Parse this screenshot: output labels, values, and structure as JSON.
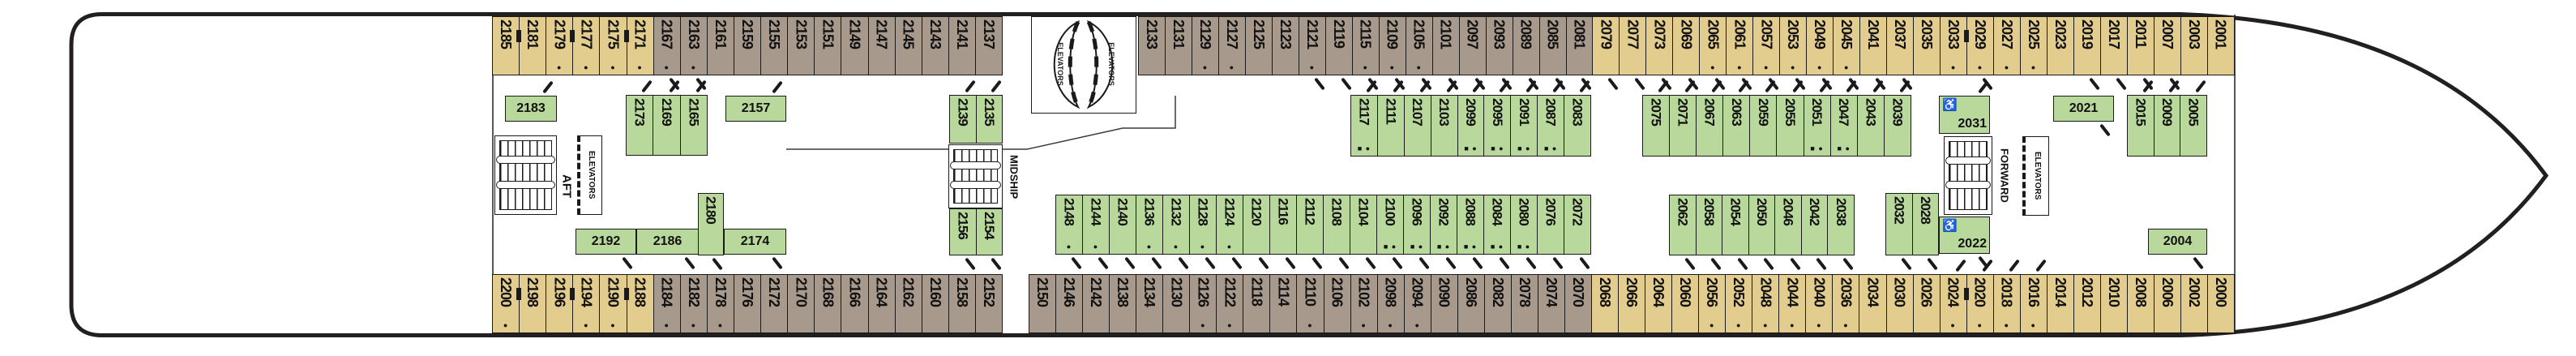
{
  "labels": {
    "aft": "AFT",
    "midship": "MIDSHIP",
    "forward": "FORWARD",
    "elevators": "ELEVATORS"
  },
  "symbols": {
    "dot": "●",
    "square": "■",
    "wheelchair": "♿"
  },
  "colors": {
    "oceanview_tan": "#e2cc8e",
    "oceanview_taupe": "#a79a8d",
    "inside_green": "#b9d89b",
    "outline": "#231f20"
  },
  "cabins": {
    "top_row_aft": [
      {
        "n": "2185",
        "c": "tan"
      },
      {
        "n": "2181",
        "c": "tan",
        "conn": 1
      },
      {
        "n": "2179",
        "c": "tan",
        "dot": 1
      },
      {
        "n": "2177",
        "c": "tan",
        "dot": 1,
        "conn": 1
      },
      {
        "n": "2175",
        "c": "tan",
        "dot": 1
      },
      {
        "n": "2171",
        "c": "tan",
        "dot": 1,
        "conn": 1
      },
      {
        "n": "2167",
        "c": "taupe",
        "dot": 1,
        "door": 1
      },
      {
        "n": "2163",
        "c": "taupe",
        "dot": 1,
        "door": 1
      },
      {
        "n": "2161",
        "c": "taupe"
      },
      {
        "n": "2159",
        "c": "taupe"
      },
      {
        "n": "2155",
        "c": "taupe"
      },
      {
        "n": "2153",
        "c": "taupe"
      },
      {
        "n": "2151",
        "c": "taupe"
      },
      {
        "n": "2149",
        "c": "taupe"
      },
      {
        "n": "2147",
        "c": "taupe"
      },
      {
        "n": "2145",
        "c": "taupe"
      },
      {
        "n": "2143",
        "c": "taupe"
      },
      {
        "n": "2141",
        "c": "taupe"
      },
      {
        "n": "2137",
        "c": "taupe"
      }
    ],
    "top_row_forward": [
      {
        "n": "2133",
        "c": "taupe"
      },
      {
        "n": "2131",
        "c": "taupe"
      },
      {
        "n": "2129",
        "c": "taupe",
        "dot": 1
      },
      {
        "n": "2127",
        "c": "taupe",
        "dot": 1
      },
      {
        "n": "2125",
        "c": "taupe"
      },
      {
        "n": "2123",
        "c": "taupe"
      },
      {
        "n": "2121",
        "c": "taupe",
        "dot": 1,
        "door": 1
      },
      {
        "n": "2119",
        "c": "taupe",
        "door": 1
      },
      {
        "n": "2115",
        "c": "taupe",
        "dot": 1,
        "door": 1
      },
      {
        "n": "2109",
        "c": "taupe",
        "dot": 1,
        "door": 1
      },
      {
        "n": "2105",
        "c": "taupe",
        "dot": 1,
        "door": 1
      },
      {
        "n": "2101",
        "c": "taupe",
        "door": 1
      },
      {
        "n": "2097",
        "c": "taupe",
        "door": 1
      },
      {
        "n": "2093",
        "c": "taupe",
        "door": 1
      },
      {
        "n": "2089",
        "c": "taupe",
        "door": 1
      },
      {
        "n": "2085",
        "c": "taupe",
        "door": 1
      },
      {
        "n": "2081",
        "c": "taupe",
        "door": 1
      },
      {
        "n": "2079",
        "c": "tan",
        "door": 1
      },
      {
        "n": "2077",
        "c": "tan",
        "door": 1
      },
      {
        "n": "2073",
        "c": "tan",
        "door": 1
      },
      {
        "n": "2069",
        "c": "tan",
        "door": 1
      },
      {
        "n": "2065",
        "c": "tan",
        "dot": 1,
        "door": 1
      },
      {
        "n": "2061",
        "c": "tan",
        "dot": 1,
        "door": 1
      },
      {
        "n": "2057",
        "c": "tan",
        "dot": 1,
        "door": 1
      },
      {
        "n": "2053",
        "c": "tan",
        "dot": 1,
        "door": 1
      },
      {
        "n": "2049",
        "c": "tan",
        "dot": 1,
        "door": 1
      },
      {
        "n": "2045",
        "c": "tan",
        "dot": 1,
        "door": 1
      },
      {
        "n": "2041",
        "c": "tan",
        "door": 1
      },
      {
        "n": "2037",
        "c": "tan",
        "door": 1
      },
      {
        "n": "2035",
        "c": "tan"
      },
      {
        "n": "2033",
        "c": "tan",
        "dot": 1
      },
      {
        "n": "2029",
        "c": "tan",
        "dot": 1,
        "conn": 1,
        "door": 1
      },
      {
        "n": "2027",
        "c": "tan",
        "dot": 1
      },
      {
        "n": "2025",
        "c": "tan",
        "dot": 1
      },
      {
        "n": "2023",
        "c": "tan"
      },
      {
        "n": "2019",
        "c": "tan",
        "door": 1
      },
      {
        "n": "2017",
        "c": "tan",
        "door": 1
      },
      {
        "n": "2011",
        "c": "tan",
        "door": 1
      },
      {
        "n": "2007",
        "c": "tan",
        "door": 1
      },
      {
        "n": "2003",
        "c": "tan"
      },
      {
        "n": "2001",
        "c": "tan"
      }
    ],
    "bottom_row_aft": [
      {
        "n": "2200",
        "c": "tan",
        "dot": 1
      },
      {
        "n": "2198",
        "c": "tan",
        "conn": 1
      },
      {
        "n": "2196",
        "c": "tan"
      },
      {
        "n": "2194",
        "c": "tan",
        "dot": 1,
        "conn": 1
      },
      {
        "n": "2190",
        "c": "tan",
        "dot": 1
      },
      {
        "n": "2188",
        "c": "tan",
        "conn": 1
      },
      {
        "n": "2184",
        "c": "taupe",
        "dot": 1
      },
      {
        "n": "2182",
        "c": "taupe",
        "dot": 1
      },
      {
        "n": "2178",
        "c": "taupe",
        "dot": 1
      },
      {
        "n": "2176",
        "c": "taupe"
      },
      {
        "n": "2172",
        "c": "taupe"
      },
      {
        "n": "2170",
        "c": "taupe"
      },
      {
        "n": "2168",
        "c": "taupe"
      },
      {
        "n": "2166",
        "c": "taupe"
      },
      {
        "n": "2164",
        "c": "taupe"
      },
      {
        "n": "2162",
        "c": "taupe"
      },
      {
        "n": "2160",
        "c": "taupe"
      },
      {
        "n": "2158",
        "c": "taupe"
      },
      {
        "n": "2152",
        "c": "taupe"
      }
    ],
    "bottom_row_forward": [
      {
        "n": "2150",
        "c": "taupe"
      },
      {
        "n": "2146",
        "c": "taupe"
      },
      {
        "n": "2142",
        "c": "taupe"
      },
      {
        "n": "2138",
        "c": "taupe"
      },
      {
        "n": "2134",
        "c": "taupe"
      },
      {
        "n": "2130",
        "c": "taupe"
      },
      {
        "n": "2126",
        "c": "taupe",
        "dot": 1
      },
      {
        "n": "2122",
        "c": "taupe",
        "dot": 1
      },
      {
        "n": "2118",
        "c": "taupe"
      },
      {
        "n": "2114",
        "c": "taupe"
      },
      {
        "n": "2110",
        "c": "taupe",
        "dot": 1
      },
      {
        "n": "2106",
        "c": "taupe"
      },
      {
        "n": "2102",
        "c": "taupe",
        "dot": 1
      },
      {
        "n": "2098",
        "c": "taupe",
        "dot": 1
      },
      {
        "n": "2094",
        "c": "taupe",
        "dot": 1
      },
      {
        "n": "2090",
        "c": "taupe"
      },
      {
        "n": "2086",
        "c": "taupe"
      },
      {
        "n": "2082",
        "c": "taupe"
      },
      {
        "n": "2078",
        "c": "taupe"
      },
      {
        "n": "2074",
        "c": "taupe"
      },
      {
        "n": "2070",
        "c": "taupe"
      },
      {
        "n": "2068",
        "c": "tan"
      },
      {
        "n": "2066",
        "c": "tan"
      },
      {
        "n": "2064",
        "c": "tan"
      },
      {
        "n": "2060",
        "c": "tan"
      },
      {
        "n": "2056",
        "c": "tan",
        "dot": 1
      },
      {
        "n": "2052",
        "c": "tan",
        "dot": 1
      },
      {
        "n": "2048",
        "c": "tan",
        "dot": 1
      },
      {
        "n": "2044",
        "c": "tan",
        "dot": 1
      },
      {
        "n": "2040",
        "c": "tan",
        "dot": 1
      },
      {
        "n": "2036",
        "c": "tan",
        "dot": 1
      },
      {
        "n": "2034",
        "c": "tan"
      },
      {
        "n": "2030",
        "c": "tan"
      },
      {
        "n": "2026",
        "c": "tan"
      },
      {
        "n": "2024",
        "c": "tan",
        "dot": 1,
        "door": 1
      },
      {
        "n": "2020",
        "c": "tan",
        "dot": 1,
        "conn": 1,
        "door": 1
      },
      {
        "n": "2018",
        "c": "tan",
        "dot": 1,
        "door": 1
      },
      {
        "n": "2016",
        "c": "tan",
        "dot": 1,
        "door": 1
      },
      {
        "n": "2014",
        "c": "tan"
      },
      {
        "n": "2012",
        "c": "tan"
      },
      {
        "n": "2010",
        "c": "tan"
      },
      {
        "n": "2008",
        "c": "tan"
      },
      {
        "n": "2006",
        "c": "tan"
      },
      {
        "n": "2002",
        "c": "tan"
      },
      {
        "n": "2000",
        "c": "tan"
      }
    ],
    "green_top_aft": [
      {
        "n": "2173"
      },
      {
        "n": "2169"
      },
      {
        "n": "2165"
      }
    ],
    "green_top_mid_pair": [
      {
        "n": "2139"
      },
      {
        "n": "2135"
      }
    ],
    "green_top_center1": [
      {
        "n": "2117",
        "sq": 1,
        "dot": 1
      },
      {
        "n": "2111"
      },
      {
        "n": "2107"
      },
      {
        "n": "2103"
      },
      {
        "n": "2099",
        "sq": 1,
        "dot": 1
      },
      {
        "n": "2095",
        "sq": 1,
        "dot": 1
      },
      {
        "n": "2091",
        "sq": 1,
        "dot": 1
      },
      {
        "n": "2087",
        "sq": 1,
        "dot": 1
      },
      {
        "n": "2083"
      }
    ],
    "green_top_center2": [
      {
        "n": "2075"
      },
      {
        "n": "2071"
      },
      {
        "n": "2067"
      },
      {
        "n": "2063"
      },
      {
        "n": "2059"
      },
      {
        "n": "2055"
      },
      {
        "n": "2051",
        "sq": 1,
        "dot": 1
      },
      {
        "n": "2047",
        "sq": 1,
        "dot": 1
      },
      {
        "n": "2043"
      },
      {
        "n": "2039"
      }
    ],
    "green_top_forward": [
      {
        "n": "2015"
      },
      {
        "n": "2009"
      },
      {
        "n": "2005"
      }
    ],
    "green_bottom_2180": [
      {
        "n": "2180"
      }
    ],
    "green_bottom_mid_pair": [
      {
        "n": "2156"
      },
      {
        "n": "2154"
      }
    ],
    "green_bottom_center1": [
      {
        "n": "2148",
        "dot": 1
      },
      {
        "n": "2144",
        "dot": 1
      },
      {
        "n": "2140"
      },
      {
        "n": "2136",
        "dot": 1
      },
      {
        "n": "2132",
        "dot": 1
      },
      {
        "n": "2128",
        "dot": 1
      },
      {
        "n": "2124",
        "dot": 1
      },
      {
        "n": "2120"
      },
      {
        "n": "2116"
      },
      {
        "n": "2112"
      },
      {
        "n": "2108"
      },
      {
        "n": "2104"
      },
      {
        "n": "2100",
        "sq": 1,
        "dot": 1
      },
      {
        "n": "2096",
        "sq": 1,
        "dot": 1
      },
      {
        "n": "2092",
        "sq": 1,
        "dot": 1
      },
      {
        "n": "2088",
        "sq": 1,
        "dot": 1
      },
      {
        "n": "2084",
        "sq": 1,
        "dot": 1
      },
      {
        "n": "2080",
        "sq": 1,
        "dot": 1
      },
      {
        "n": "2076"
      },
      {
        "n": "2072"
      }
    ],
    "green_bottom_center2": [
      {
        "n": "2062"
      },
      {
        "n": "2058"
      },
      {
        "n": "2054"
      },
      {
        "n": "2050"
      },
      {
        "n": "2046"
      },
      {
        "n": "2042"
      },
      {
        "n": "2038"
      }
    ],
    "green_bottom_pair": [
      {
        "n": "2032"
      },
      {
        "n": "2028"
      }
    ],
    "horizontal": {
      "c2183": "2183",
      "c2157": "2157",
      "c2192": "2192",
      "c2186": "2186",
      "c2174": "2174",
      "c2021": "2021",
      "c2004": "2004"
    },
    "accessible": {
      "c2031": "2031",
      "c2022": "2022"
    }
  }
}
